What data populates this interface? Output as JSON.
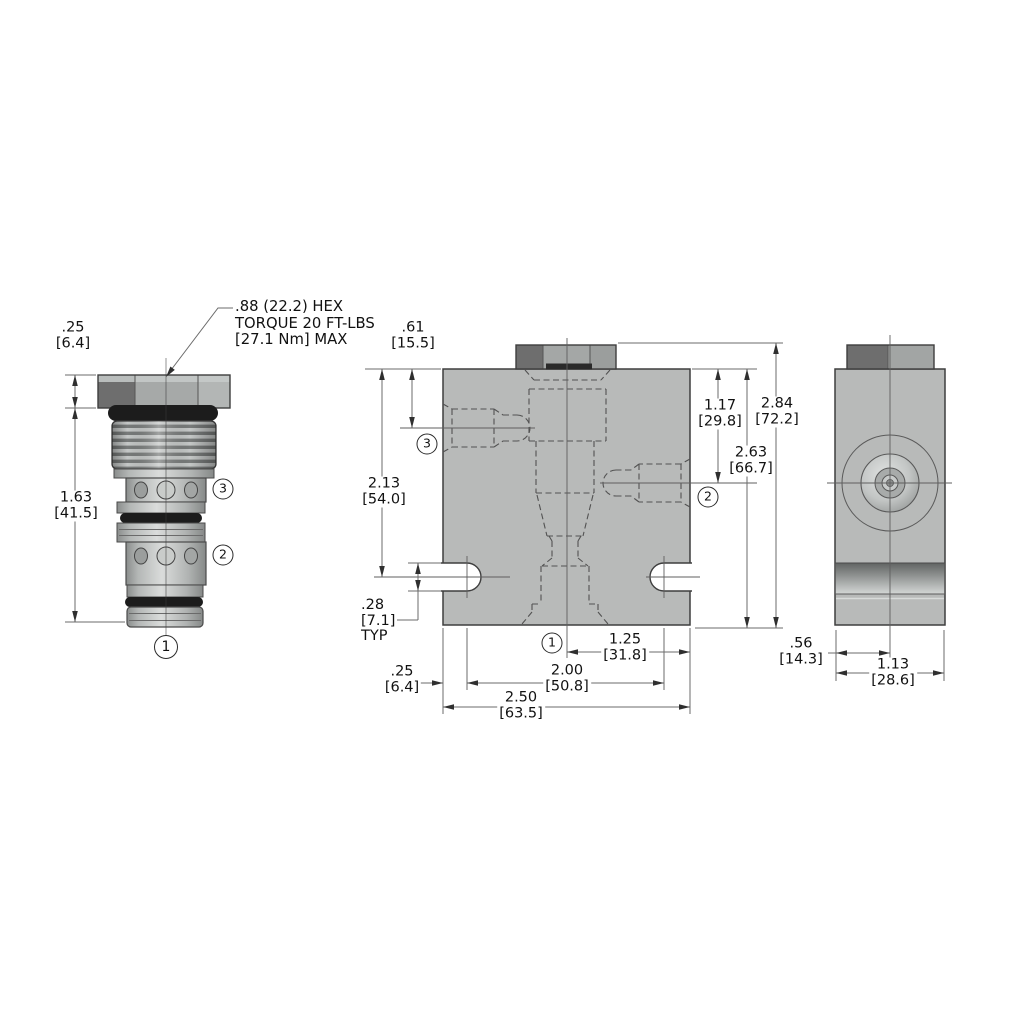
{
  "drawing_type": "cartridge-valve-dimensional-drawing",
  "callout": {
    "line1": ".88 (22.2) HEX",
    "line2": "TORQUE 20 FT-LBS",
    "line3": "[27.1 Nm] MAX"
  },
  "dimensions": {
    "hex_height": {
      "in": ".25",
      "mm": "[6.4]"
    },
    "cartridge_length": {
      "in": "1.63",
      "mm": "[41.5]"
    },
    "port3_center_depth": {
      "in": ".61",
      "mm": "[15.5]"
    },
    "slot_center_depth": {
      "in": "2.13",
      "mm": "[54.0]"
    },
    "slot_width": {
      "in": ".28",
      "mm": "[7.1]",
      "note": "TYP"
    },
    "edge_to_slot": {
      "in": ".25",
      "mm": "[6.4]"
    },
    "port2_center_depth": {
      "in": "1.17",
      "mm": "[29.8]"
    },
    "overall_height": {
      "in": "2.84",
      "mm": "[72.2]"
    },
    "body_height": {
      "in": "2.63",
      "mm": "[66.7]"
    },
    "center_to_edge": {
      "in": "1.25",
      "mm": "[31.8]"
    },
    "slot_spacing": {
      "in": "2.00",
      "mm": "[50.8]"
    },
    "body_width": {
      "in": "2.50",
      "mm": "[63.5]"
    },
    "edge_to_centerline": {
      "in": ".56",
      "mm": "[14.3]"
    },
    "body_depth": {
      "in": "1.13",
      "mm": "[28.6]"
    }
  },
  "ports": {
    "p1": "1",
    "p2": "2",
    "p3": "3"
  },
  "colors": {
    "background": "#ffffff",
    "body_gray": "#b8bab9",
    "outline": "#3e3e3e",
    "oring_black": "#1c1c1c",
    "hex_dark_facet": "#6e6e6e",
    "hex_mid_facet": "#a6a9a8",
    "hex_light_facet": "#b3b6b5",
    "dimension_line": "#6b6b6b",
    "hidden_line": "#525252",
    "text": "#111111"
  }
}
